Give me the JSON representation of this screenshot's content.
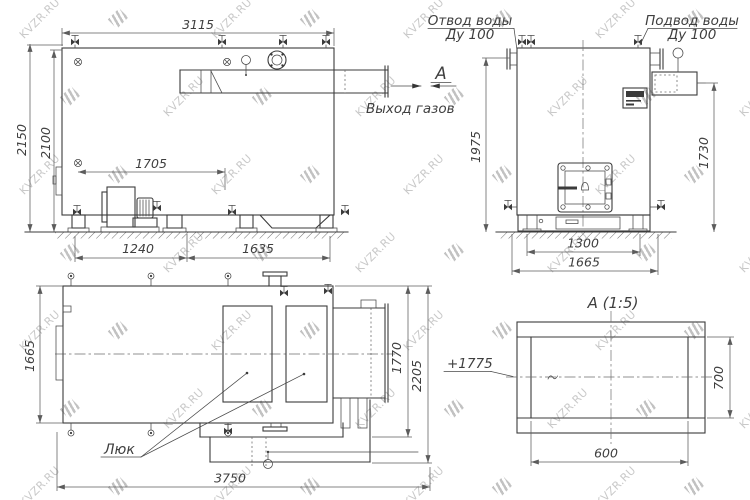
{
  "watermark": {
    "text": "KVZR.RU"
  },
  "side_view": {
    "dim_length": "3115",
    "dim_height_total": "2150",
    "dim_height_body": "2100",
    "dim_blower": "1705",
    "dim_foot_left": "1240",
    "dim_foot_right": "1635",
    "gas_outlet_label": "Выход газов",
    "section_arrow": "A"
  },
  "front_view": {
    "outlet_label_1": "Отвод воды",
    "outlet_label_2": "Ду 100",
    "inlet_label_1": "Подвод воды",
    "inlet_label_2": "Ду 100",
    "dim_height_left": "1975",
    "dim_height_right": "1730",
    "dim_base_inner": "1300",
    "dim_base_outer": "1665"
  },
  "top_view": {
    "dim_width": "1665",
    "dim_depth_inner": "1770",
    "dim_depth_outer": "2205",
    "dim_length": "3750",
    "hatch_label": "Люк"
  },
  "section_view": {
    "title": "А (1:5)",
    "elevation": "+1775",
    "dim_width": "600",
    "dim_height": "700"
  }
}
